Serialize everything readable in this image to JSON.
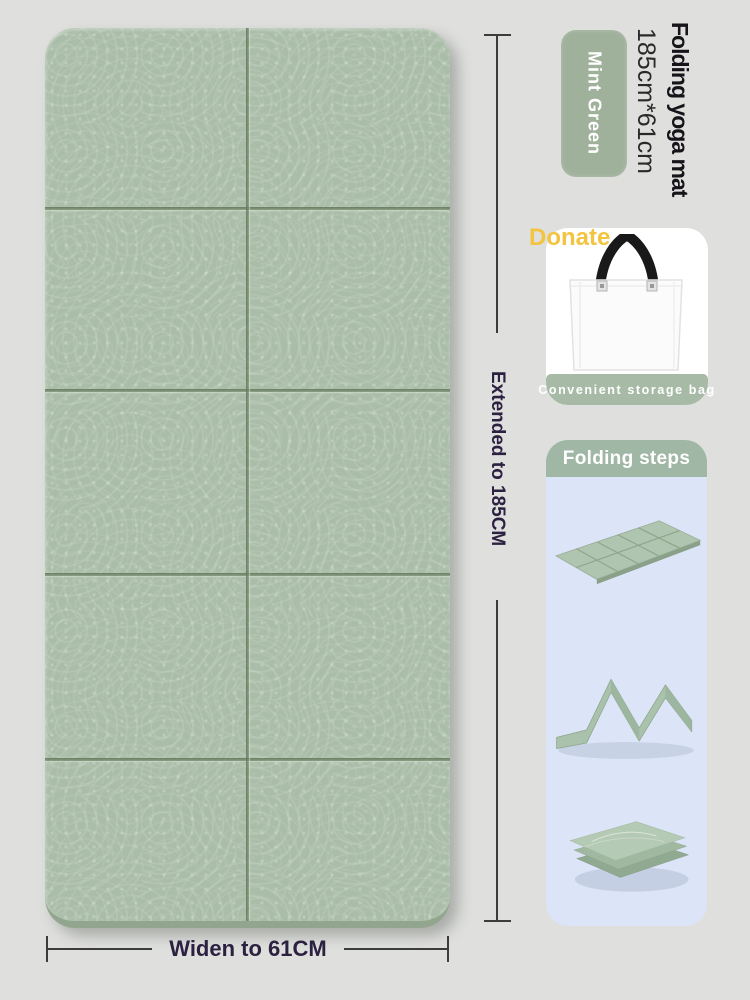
{
  "page": {
    "background": "#dfe0de"
  },
  "product": {
    "title": "Folding yoga mat",
    "size": "185cm*61cm",
    "color_badge_label": "Mint Green",
    "badge_color": "#9fb19b"
  },
  "mat": {
    "color": "#aabda8",
    "fold_rows": 5,
    "fold_columns": 2,
    "length_label": "Extended to 185CM",
    "width_label": "Widen to 61CM",
    "dimension_text_color": "#2c2140"
  },
  "storage": {
    "donate_label": "Donate",
    "donate_color": "#f2c43f",
    "caption": "Convenient storage bag",
    "caption_bg": "#a6baa6",
    "bag_icon": "tote-bag-icon"
  },
  "folding_steps": {
    "header": "Folding steps",
    "header_bg": "#a0b7a5",
    "body_bg": "#dce4f7",
    "steps": [
      {
        "name": "step-1-unfolded-flat-mat"
      },
      {
        "name": "step-2-accordion-folded"
      },
      {
        "name": "step-3-fully-folded-stack"
      }
    ]
  }
}
